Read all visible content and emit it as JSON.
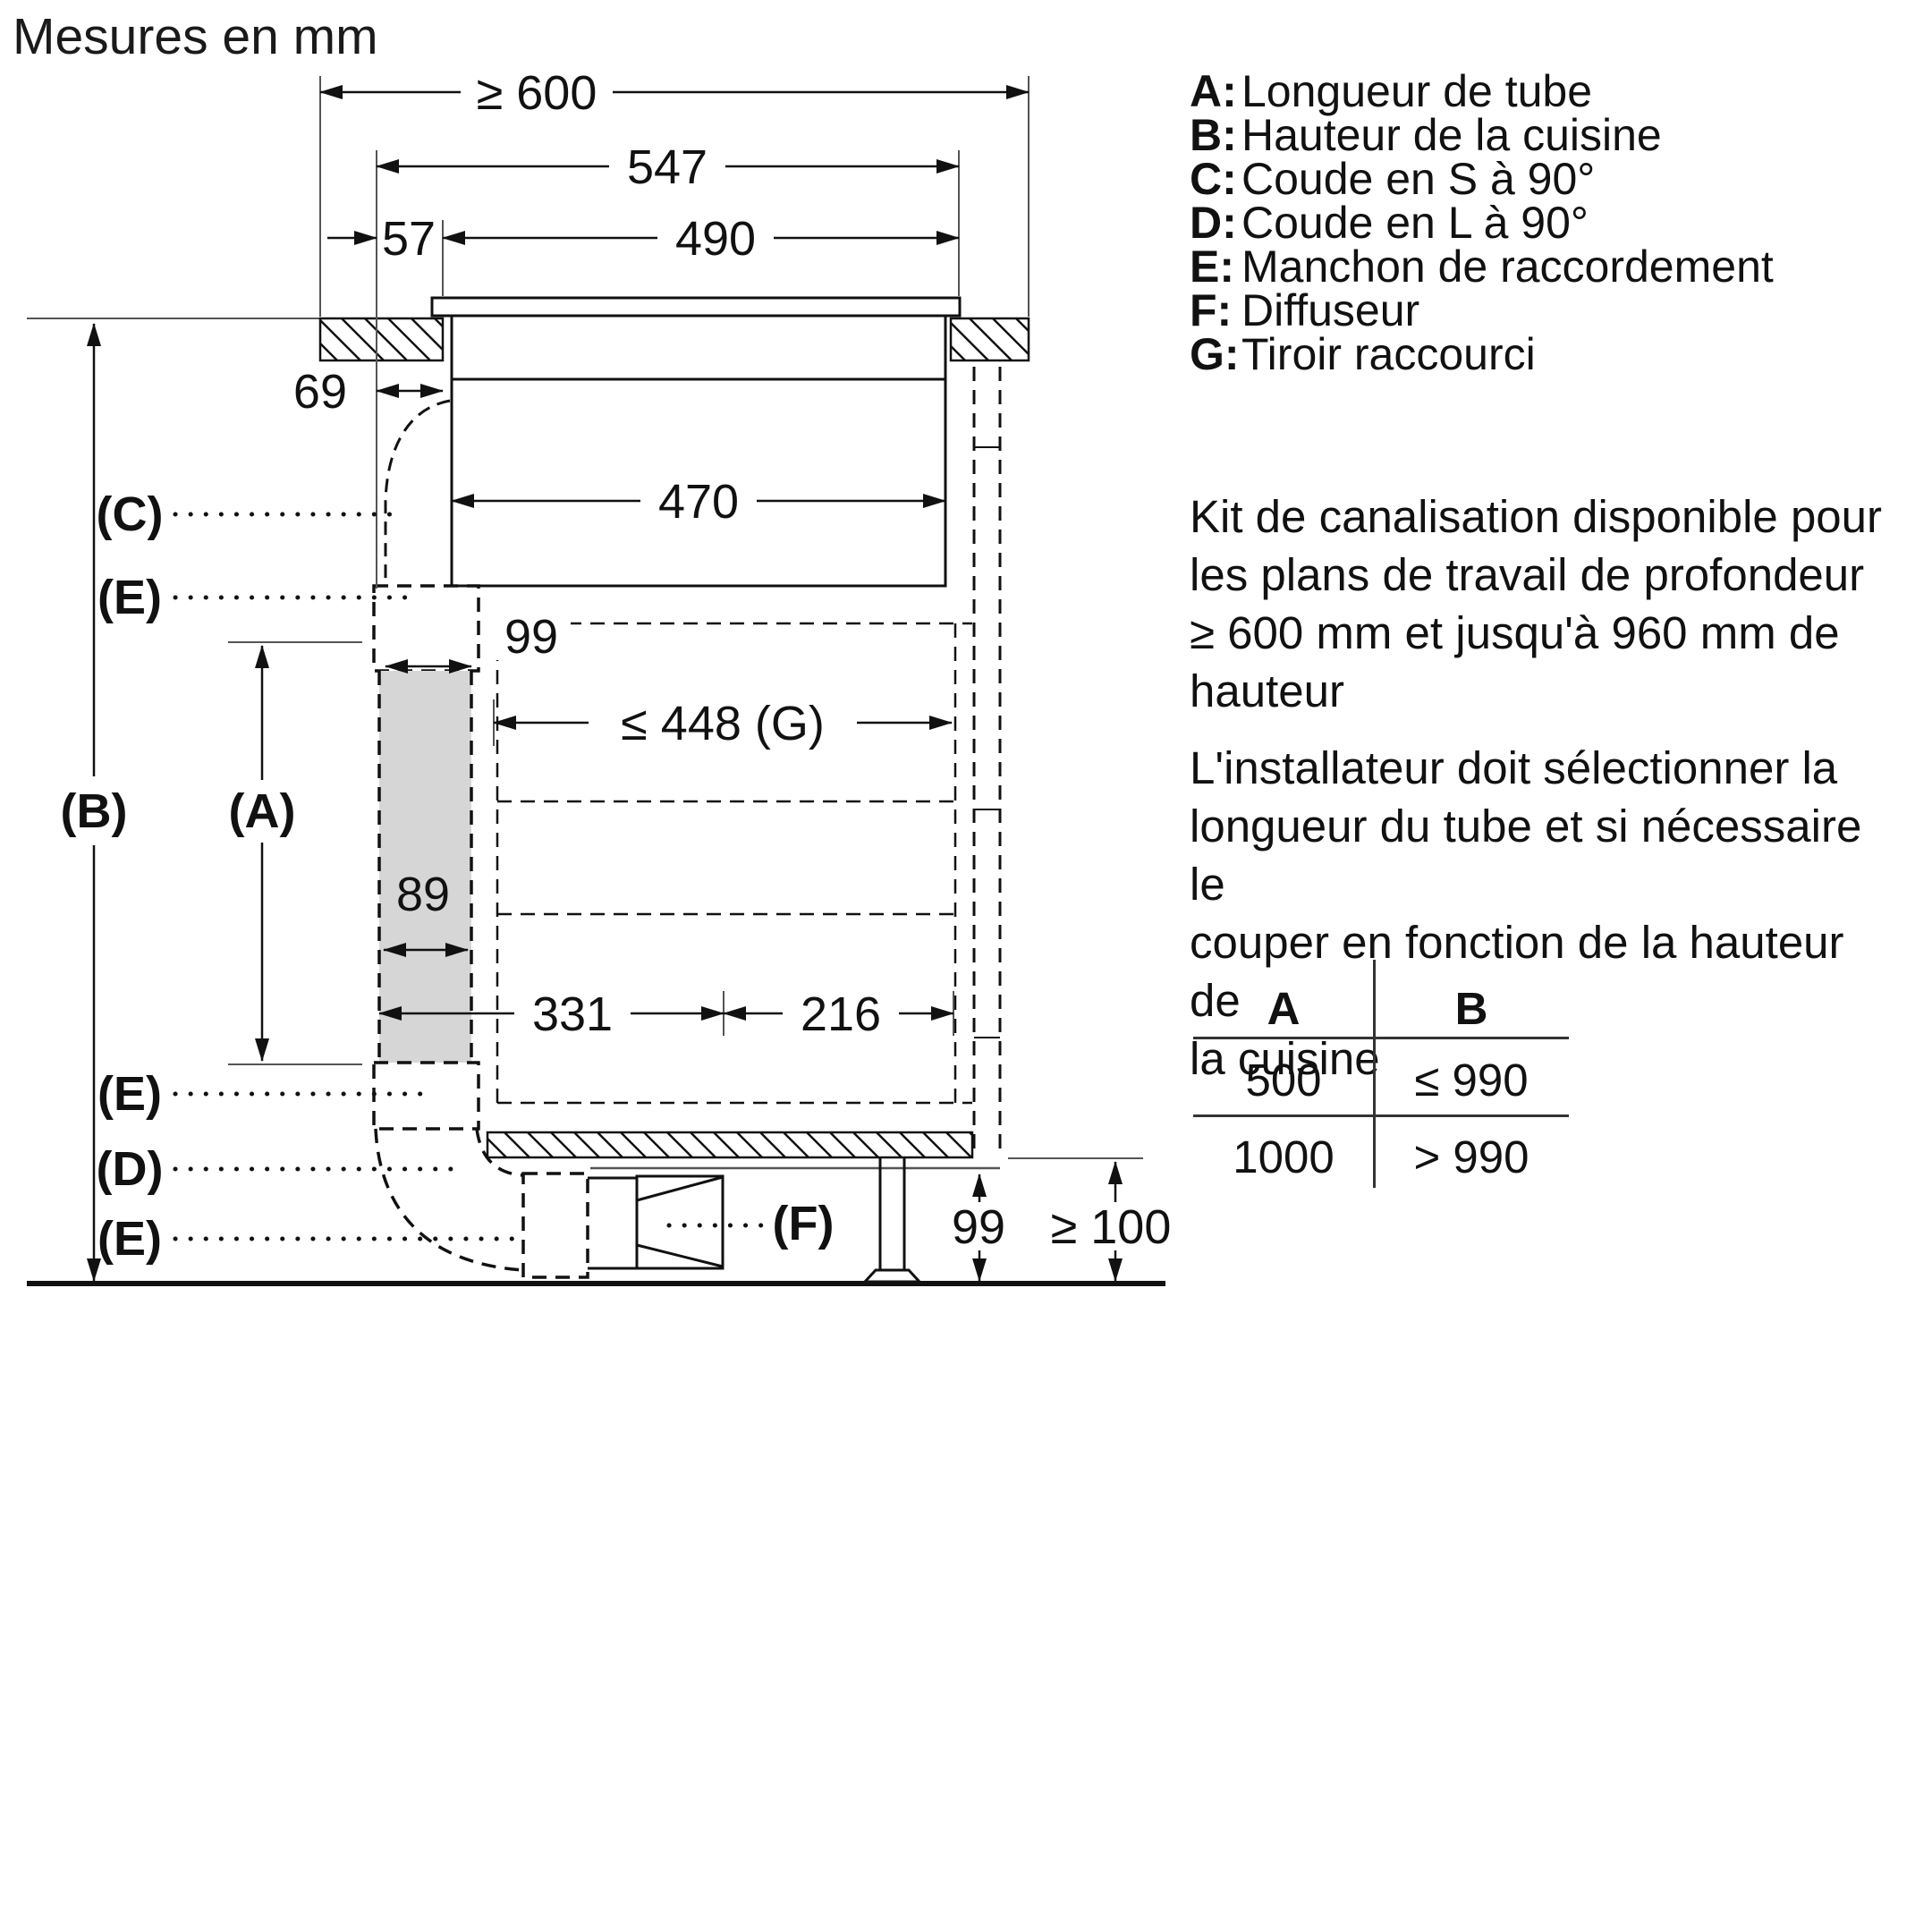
{
  "title": "Mesures en mm",
  "legend": {
    "items": [
      {
        "k": "A:",
        "v": "Longueur de tube"
      },
      {
        "k": "B:",
        "v": "Hauteur de la cuisine"
      },
      {
        "k": "C:",
        "v": "Coude en S à 90°"
      },
      {
        "k": "D:",
        "v": "Coude en L à 90°"
      },
      {
        "k": "E:",
        "v": "Manchon de raccordement"
      },
      {
        "k": "F:",
        "v": "Diffuseur"
      },
      {
        "k": "G:",
        "v": "Tiroir raccourci"
      }
    ]
  },
  "notes": {
    "kit": [
      "Kit de canalisation disponible pour",
      "les plans de travail de profondeur",
      "≥ 600 mm et jusqu'à 960 mm de",
      "hauteur"
    ],
    "installer": [
      "L'installateur doit sélectionner la",
      "longueur du tube et si nécessaire le",
      "couper en fonction de la hauteur de",
      "la cuisine"
    ]
  },
  "table": {
    "header": [
      "A",
      "B"
    ],
    "rows": [
      [
        "500",
        "≤ 990"
      ],
      [
        "1000",
        "> 990"
      ]
    ]
  },
  "dims": {
    "worktop_min_depth": "≥ 600",
    "hob_width": "547",
    "front_offset": "57",
    "cutout_width": "490",
    "side_inset": "69",
    "body_width": "470",
    "sleeve_width": "99",
    "drawer_max": "≤ 448 (G)",
    "tube_width": "89",
    "front_run": "331",
    "rear_run": "216",
    "plinth_height": "99",
    "floor_clearance": "≥ 100"
  },
  "marks": {
    "a": "(A)",
    "b": "(B)",
    "c": "(C)",
    "d": "(D)",
    "e": "(E)",
    "f": "(F)"
  },
  "colors": {
    "line": "#111111",
    "tube_fill": "#d6d6d6",
    "background": "#ffffff"
  }
}
